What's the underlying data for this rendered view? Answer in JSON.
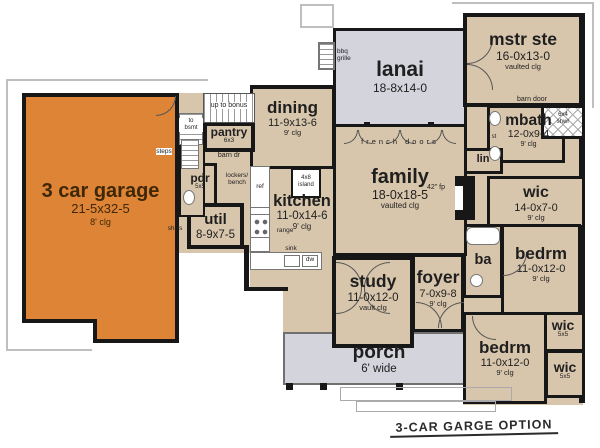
{
  "title": "3-CAR GARGE OPTION",
  "colors": {
    "garage": "#dd8436",
    "room": "#d8c6ac",
    "outdoor": "#d3d4dc",
    "wall": "#171717",
    "ink": "#1f1f1f",
    "garage_ink": "#3f2708",
    "paper": "#ffffff"
  },
  "rooms": {
    "garage": {
      "name": "3 car garage",
      "dims": "21-5x32-5",
      "clg": "8' clg"
    },
    "dining": {
      "name": "dining",
      "dims": "11-9x13-6",
      "clg": "9' clg"
    },
    "lanai": {
      "name": "lanai",
      "dims": "18-8x14-0"
    },
    "mstr_ste": {
      "name": "mstr ste",
      "dims": "16-0x13-0",
      "clg": "vaulted clg"
    },
    "mbath": {
      "name": "mbath",
      "dims": "12-0x9-4",
      "clg": "9' clg"
    },
    "wic_mstr": {
      "name": "wic",
      "dims": "14-0x7-0",
      "clg": "9' clg"
    },
    "family": {
      "name": "family",
      "dims": "18-0x18-5",
      "clg": "vaulted clg"
    },
    "kitchen": {
      "name": "kitchen",
      "dims": "11-0x14-6",
      "clg": "9' clg"
    },
    "util": {
      "name": "util",
      "dims": "8-9x7-5"
    },
    "pantry": {
      "name": "pantry",
      "dims": "6x3"
    },
    "pdr": {
      "name": "pdr",
      "dims": "5x5"
    },
    "study": {
      "name": "study",
      "dims": "11-0x12-0",
      "clg": "vault clg"
    },
    "foyer": {
      "name": "foyer",
      "dims": "7-0x9-8",
      "clg": "9' clg"
    },
    "ba": {
      "name": "ba"
    },
    "bedrm1": {
      "name": "bedrm",
      "dims": "11-0x12-0",
      "clg": "9' clg"
    },
    "wic1": {
      "name": "wic",
      "dims": "5x5"
    },
    "bedrm2": {
      "name": "bedrm",
      "dims": "11-0x12-0",
      "clg": "9' clg"
    },
    "wic2": {
      "name": "wic",
      "dims": "5x5"
    },
    "porch": {
      "name": "porch",
      "dims": "6' wide"
    }
  },
  "annotations": {
    "up_to_bonus": "up to bonus",
    "to_bsmt_1": "to",
    "to_bsmt_2": "bsmt",
    "steps": "steps",
    "barn_dr": "barn dr",
    "barn_door": "barn door",
    "lockers_1": "lockers/",
    "lockers_2": "bench",
    "ref": "ref",
    "range": "range",
    "sink": "sink",
    "dw": "dw",
    "island_1": "4x8",
    "island_2": "island",
    "french_doors": "french doors",
    "fp": "42\" fp",
    "lin": "lin",
    "st": "st",
    "shwr_1": "6x4",
    "shwr_2": "shwr",
    "bbq_1": "bbq",
    "bbq_2": "grille",
    "shlvs": "shlvs"
  }
}
